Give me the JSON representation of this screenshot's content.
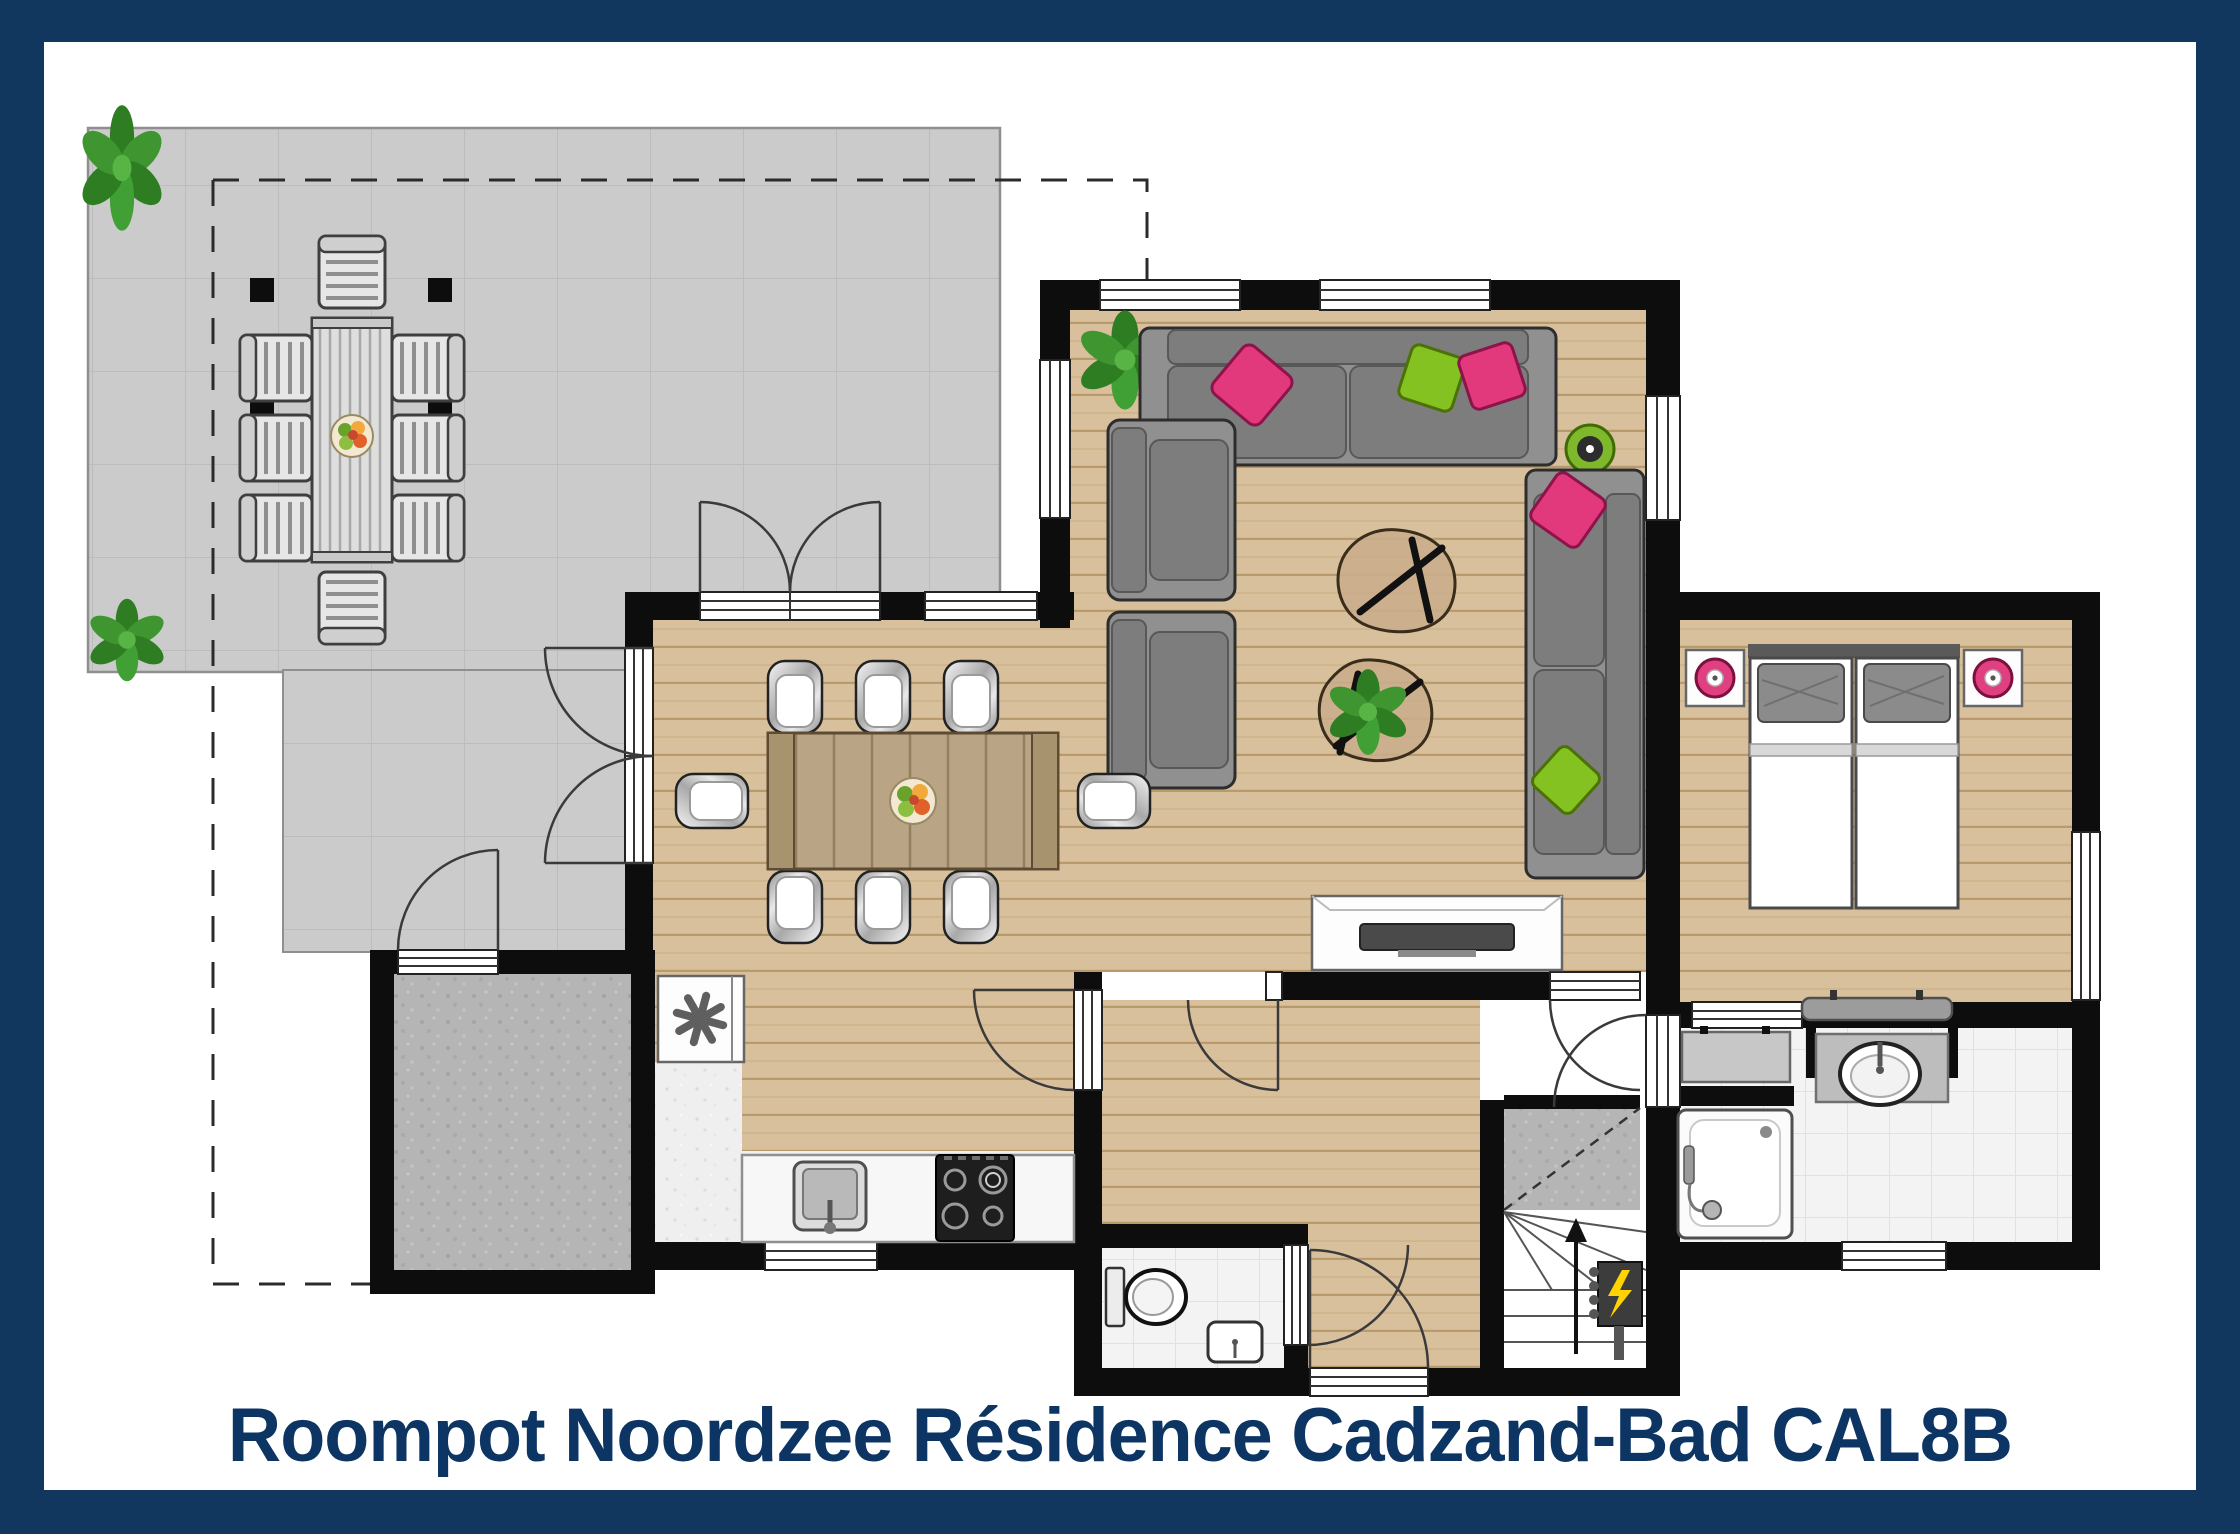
{
  "title": {
    "caption": "Roompot Noordzee Résidence Cadzand-Bad CAL8B"
  },
  "colors": {
    "frame_navy": "#11375f",
    "title_text": "#0d3564",
    "wall": "#0d0d0d",
    "wood": "#d9c09c",
    "terrace": "#cbcbcb",
    "tile": "#f3f3f3",
    "concrete": "#b5b5b5",
    "sofa": "#909090",
    "pink": "#e2397c",
    "green": "#84c221",
    "plant": "#2e7d22"
  },
  "legend": {
    "rooms": [
      "terrace",
      "storage-room",
      "dining-area",
      "kitchen",
      "living-room",
      "hallway",
      "toilet-room",
      "bedroom",
      "bathroom",
      "stairs-closet"
    ],
    "furniture_icons": [
      "outdoor-table-icon",
      "outdoor-chair-icon",
      "pergola-post-icon",
      "plant-icon",
      "dining-table-icon",
      "dining-chair-icon",
      "fruit-bowl-icon",
      "sofa-icon",
      "corner-sofa-icon",
      "armchair-icon",
      "coffee-table-icon",
      "tv-sideboard-icon",
      "side-table-icon",
      "freezer-icon",
      "kitchen-sink-icon",
      "gas-hob-icon",
      "kitchen-window-icon",
      "toilet-icon",
      "hand-basin-icon",
      "front-door-icon",
      "staircase-icon",
      "up-arrow-icon",
      "electric-panel-icon",
      "bed-icon",
      "pillow-icon",
      "nightstand-icon",
      "bedside-lamp-icon",
      "radiator-icon",
      "shower-icon",
      "washbasin-icon",
      "bathroom-cabinet-icon"
    ]
  }
}
